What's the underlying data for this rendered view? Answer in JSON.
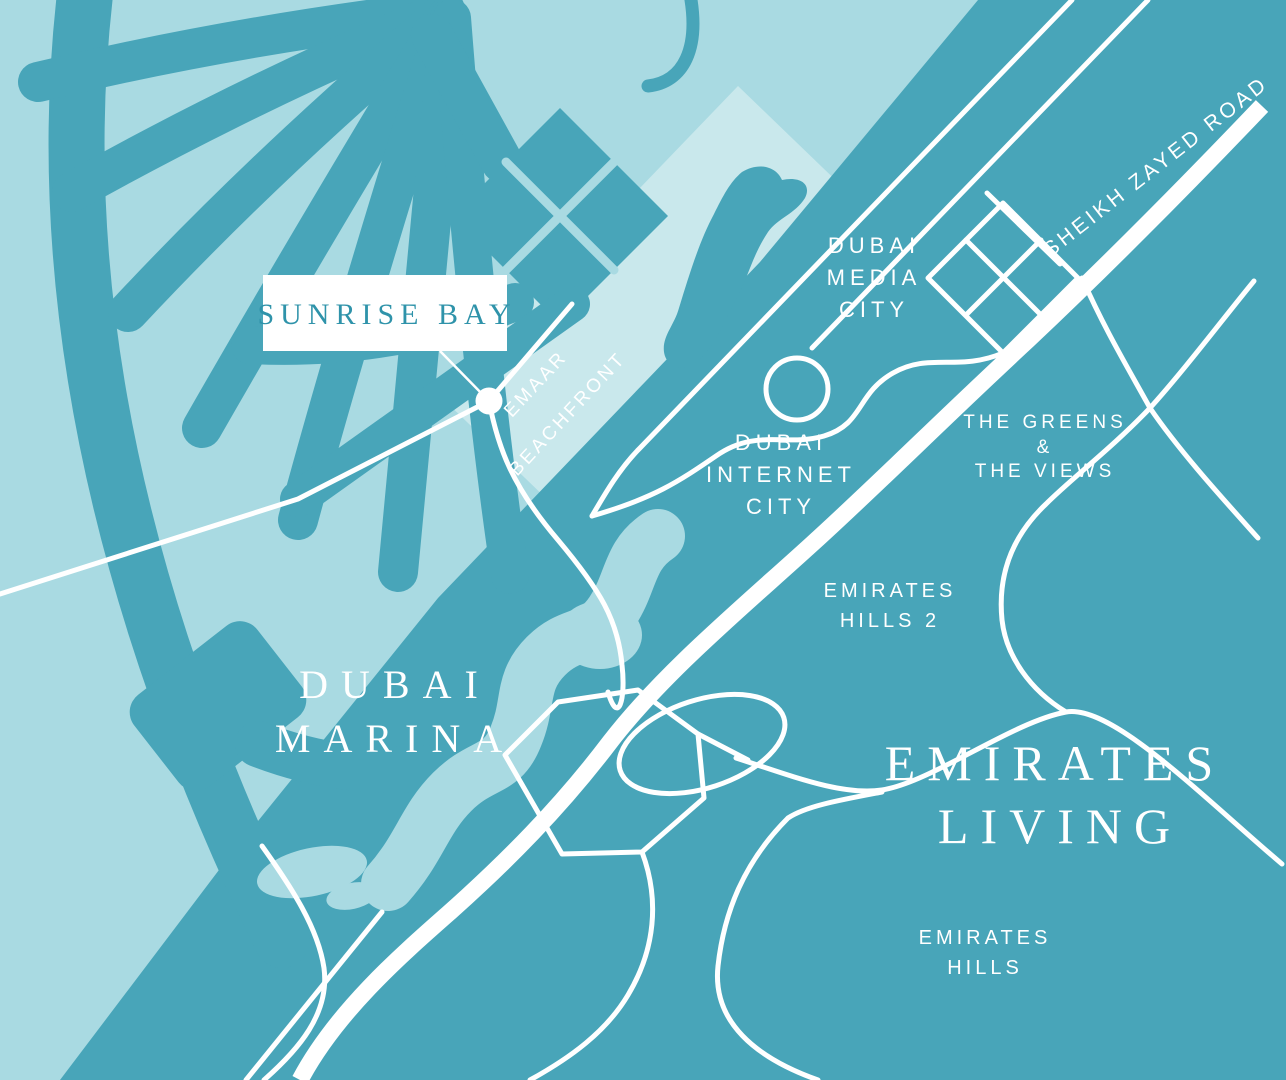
{
  "map": {
    "type": "stylized-location-map",
    "project_label": "SUNRISE BAY",
    "colors": {
      "water_light": "#a9dae2",
      "beachfront_strip": "#c9e8ec",
      "land_teal": "#48a5b9",
      "road_white": "#ffffff",
      "label_text_teal": "#2f93aa"
    },
    "labels": {
      "sunrise_bay": "SUNRISE BAY",
      "emaar_beachfront": [
        "EMAAR",
        "BEACHFRONT"
      ],
      "dubai_media_city": [
        "DUBAI",
        "MEDIA",
        "CITY"
      ],
      "dubai_internet_city": [
        "DUBAI",
        "INTERNET",
        "CITY"
      ],
      "the_greens_the_views": [
        "THE GREENS",
        "&",
        "THE VIEWS"
      ],
      "emirates_hills_2": [
        "EMIRATES",
        "HILLS 2"
      ],
      "emirates_hills": [
        "EMIRATES",
        "HILLS"
      ],
      "dubai_marina": [
        "DUBAI",
        "MARINA"
      ],
      "emirates_living": [
        "EMIRATES",
        "LIVING"
      ],
      "sheikh_zayed_road": "SHEIKH ZAYED ROAD"
    }
  }
}
